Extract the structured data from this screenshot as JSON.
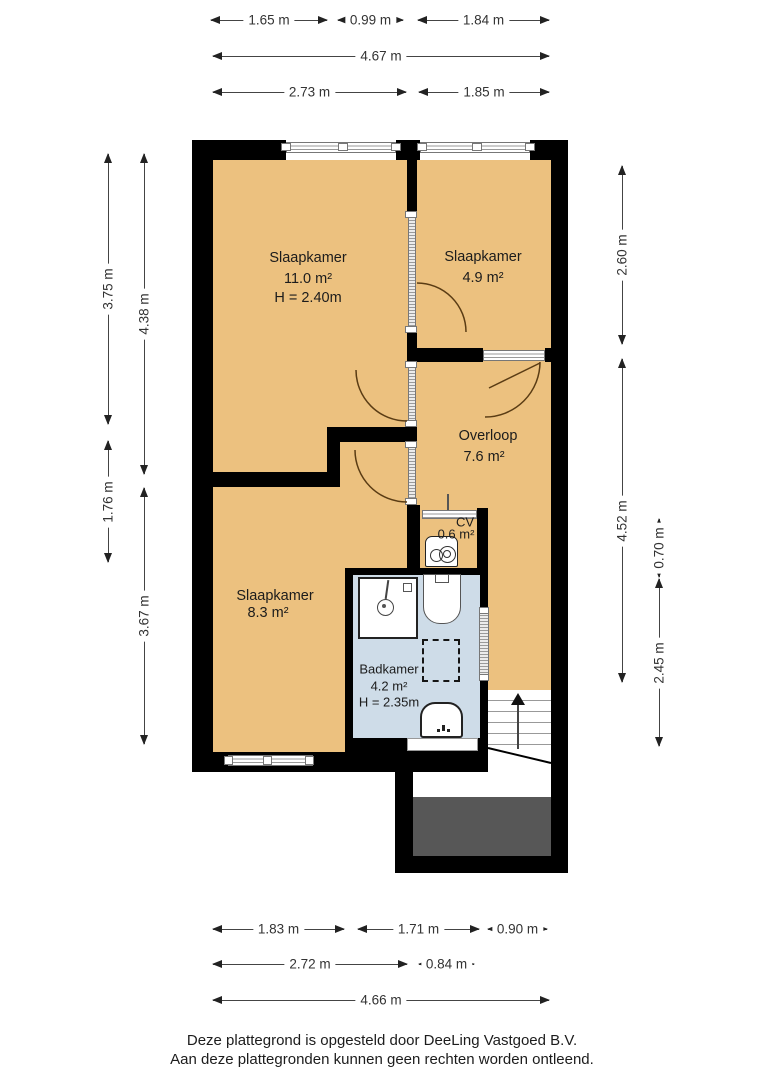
{
  "rooms": {
    "bedroom1": {
      "name": "Slaapkamer",
      "area": "11.0 m²",
      "height": "H = 2.40m"
    },
    "bedroom2": {
      "name": "Slaapkamer",
      "area": "4.9 m²"
    },
    "landing": {
      "name": "Overloop",
      "area": "7.6 m²"
    },
    "cv": {
      "name": "CV",
      "area": "0.6 m²"
    },
    "bedroom3": {
      "name": "Slaapkamer",
      "area": "8.3 m²"
    },
    "bathroom": {
      "name": "Badkamer",
      "area": "4.2 m²",
      "height": "H = 2.35m"
    }
  },
  "dimensions": {
    "top": {
      "row1": [
        "1.65 m",
        "0.99 m",
        "1.84 m"
      ],
      "row2": [
        "4.67 m"
      ],
      "row3": [
        "2.73 m",
        "1.85 m"
      ]
    },
    "left": {
      "outer": [
        "3.75 m",
        "1.76 m"
      ],
      "inner": [
        "4.38 m",
        "3.67 m"
      ]
    },
    "right": {
      "inner": [
        "2.60 m",
        "4.52 m"
      ],
      "outer": [
        "0.70 m",
        "2.45 m"
      ]
    },
    "bottom": {
      "row1": [
        "1.83 m",
        "1.71 m",
        "0.90 m"
      ],
      "row2": [
        "2.72 m",
        "0.84 m"
      ],
      "row3": [
        "4.66 m"
      ]
    }
  },
  "footer": {
    "line1": "Deze plattegrond is opgesteld door DeeLing Vastgoed B.V.",
    "line2": "Aan deze plattegronden kunnen geen rechten worden ontleend."
  },
  "colors": {
    "room_fill": "#ecc17f",
    "bathroom_fill": "#cedce8",
    "wall": "#000000",
    "void_fill": "#575757",
    "door_arc": "#5a3c14"
  }
}
